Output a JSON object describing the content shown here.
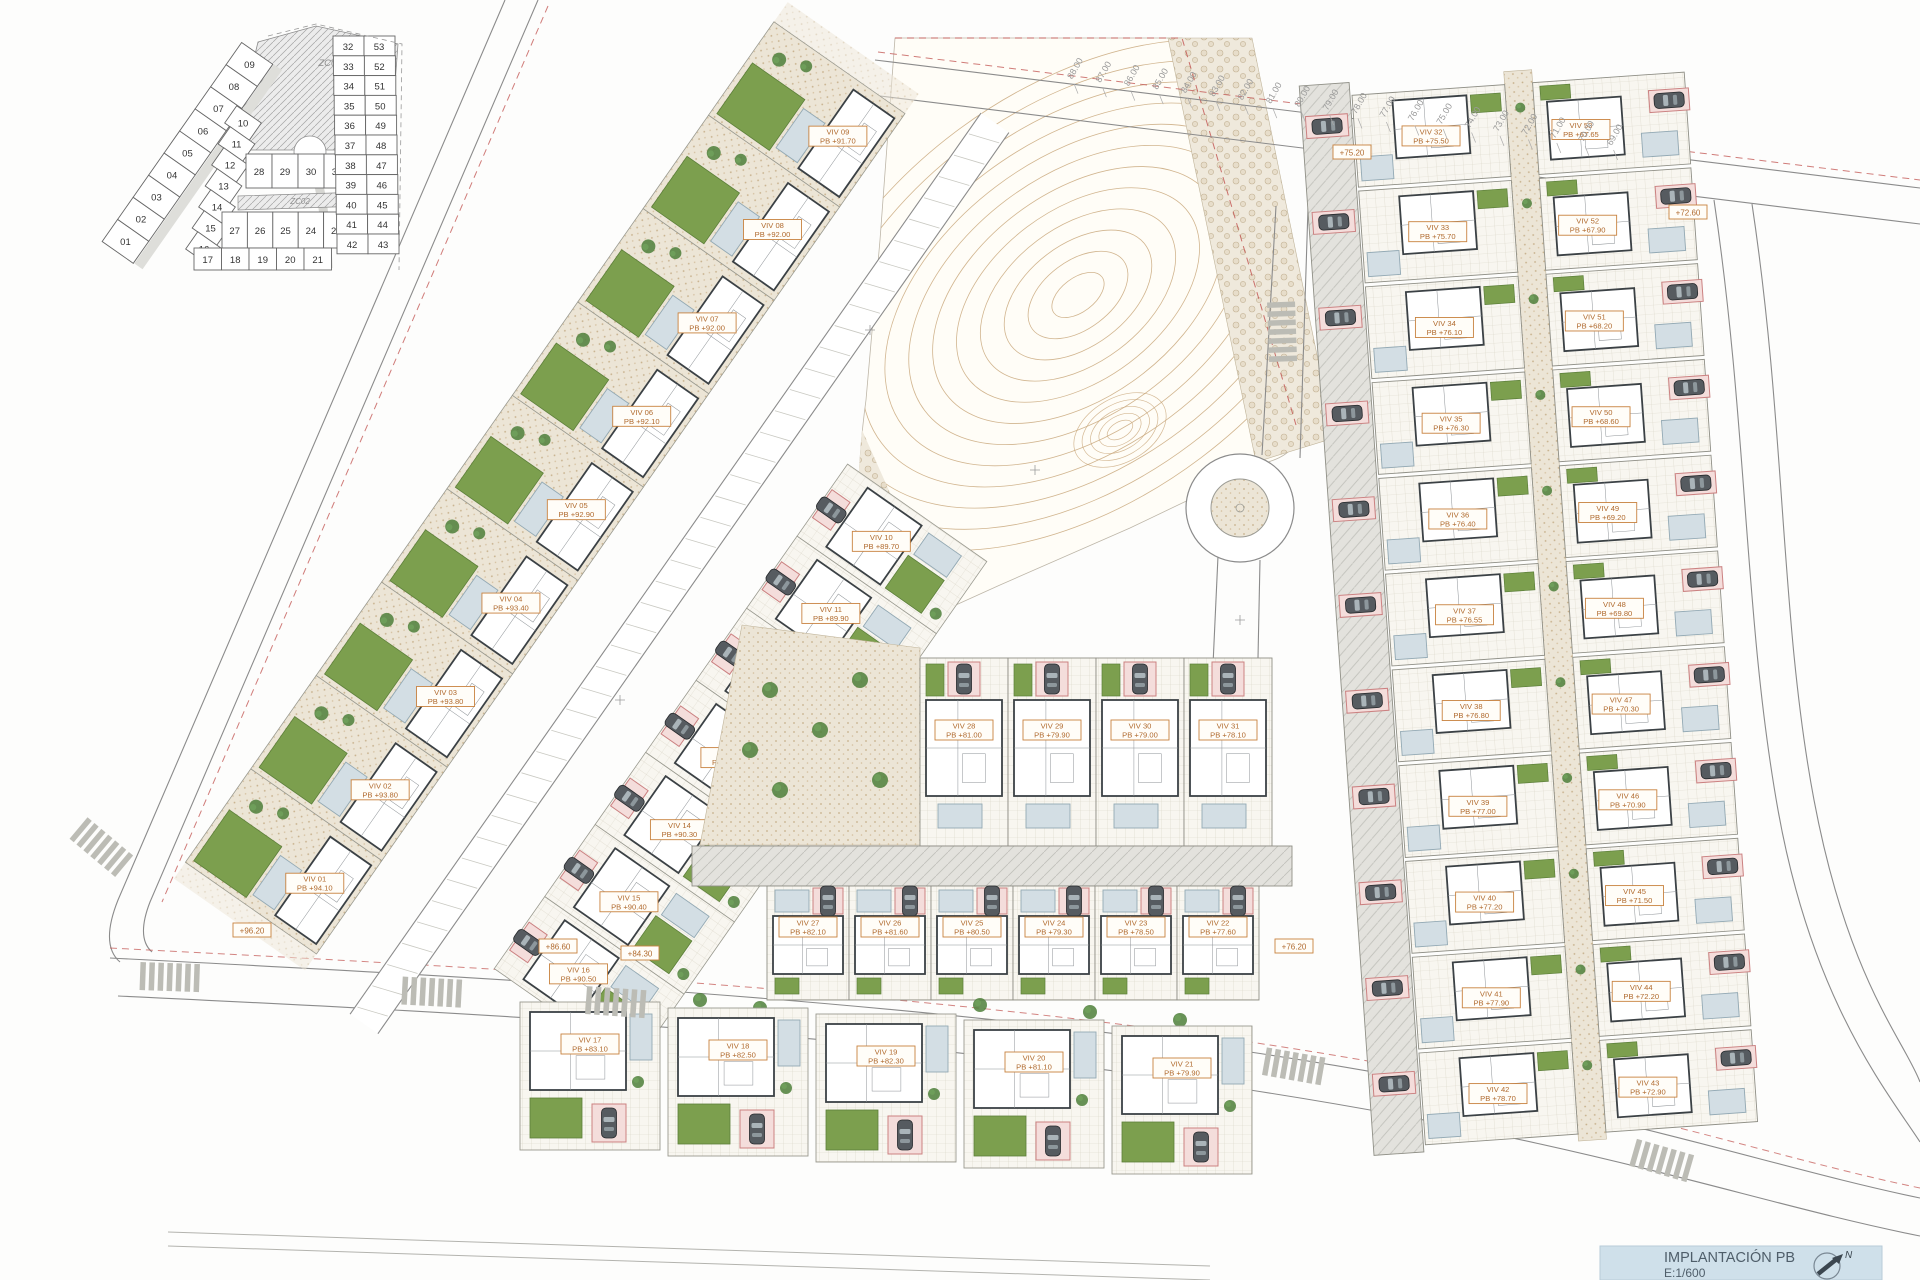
{
  "title_block": {
    "title": "IMPLANTACIÓN PB",
    "scale": "E:1/600",
    "north": "N"
  },
  "zones": {
    "zc01": "ZC01",
    "zc02": "ZC02"
  },
  "keyplan": {
    "outer_row": [
      "01",
      "02",
      "03",
      "04",
      "05",
      "06",
      "07",
      "08",
      "09"
    ],
    "inner_row": [
      "10",
      "11",
      "12",
      "13",
      "14",
      "15",
      "16"
    ],
    "mid_row": [
      "28",
      "29",
      "30",
      "31"
    ],
    "court_row": [
      "27",
      "26",
      "25",
      "24",
      "23",
      "22"
    ],
    "bottom_row": [
      "17",
      "18",
      "19",
      "20",
      "21"
    ],
    "right_left_col": [
      "32",
      "33",
      "34",
      "35",
      "36",
      "37",
      "38",
      "39",
      "40",
      "41",
      "42"
    ],
    "right_right_col": [
      "53",
      "52",
      "51",
      "50",
      "49",
      "48",
      "47",
      "46",
      "45",
      "44",
      "43"
    ]
  },
  "villas": {
    "left_outer": [
      {
        "id": "VIV 01",
        "pb": "PB +94.10"
      },
      {
        "id": "VIV 02",
        "pb": "PB +93.80"
      },
      {
        "id": "VIV 03",
        "pb": "PB +93.80"
      },
      {
        "id": "VIV 04",
        "pb": "PB +93.40"
      },
      {
        "id": "VIV 05",
        "pb": "PB +92.90"
      },
      {
        "id": "VIV 06",
        "pb": "PB +92.10"
      },
      {
        "id": "VIV 07",
        "pb": "PB +92.00"
      },
      {
        "id": "VIV 08",
        "pb": "PB +92.00"
      },
      {
        "id": "VIV 09",
        "pb": "PB +91.70"
      }
    ],
    "left_inner": [
      {
        "id": "VIV 10",
        "pb": "PB +89.70"
      },
      {
        "id": "VIV 11",
        "pb": "PB +89.90"
      },
      {
        "id": "VIV 12",
        "pb": "PB +90.10"
      },
      {
        "id": "VIV 13",
        "pb": "PB +90.10"
      },
      {
        "id": "VIV 14",
        "pb": "PB +90.30"
      },
      {
        "id": "VIV 15",
        "pb": "PB +90.40"
      },
      {
        "id": "VIV 16",
        "pb": "PB +90.50"
      }
    ],
    "bottom_row": [
      {
        "id": "VIV 17",
        "pb": "PB +83.10"
      },
      {
        "id": "VIV 18",
        "pb": "PB +82.50"
      },
      {
        "id": "VIV 19",
        "pb": "PB +82.30"
      },
      {
        "id": "VIV 20",
        "pb": "PB +81.10"
      },
      {
        "id": "VIV 21",
        "pb": "PB +79.90"
      }
    ],
    "cluster_top": [
      {
        "id": "VIV 28",
        "pb": "PB +81.00"
      },
      {
        "id": "VIV 29",
        "pb": "PB +79.90"
      },
      {
        "id": "VIV 30",
        "pb": "PB +79.00"
      },
      {
        "id": "VIV 31",
        "pb": "PB +78.10"
      }
    ],
    "cluster_bottom": [
      {
        "id": "VIV 27",
        "pb": "PB +82.10"
      },
      {
        "id": "VIV 26",
        "pb": "PB +81.60"
      },
      {
        "id": "VIV 25",
        "pb": "PB +80.50"
      },
      {
        "id": "VIV 24",
        "pb": "PB +79.30"
      },
      {
        "id": "VIV 23",
        "pb": "PB +78.50"
      },
      {
        "id": "VIV 22",
        "pb": "PB +77.60"
      }
    ],
    "right_west": [
      {
        "id": "VIV 32",
        "pb": "PB +75.50"
      },
      {
        "id": "VIV 33",
        "pb": "PB +75.70"
      },
      {
        "id": "VIV 34",
        "pb": "PB +76.10"
      },
      {
        "id": "VIV 35",
        "pb": "PB +76.30"
      },
      {
        "id": "VIV 36",
        "pb": "PB +76.40"
      },
      {
        "id": "VIV 37",
        "pb": "PB +76.55"
      },
      {
        "id": "VIV 38",
        "pb": "PB +76.80"
      },
      {
        "id": "VIV 39",
        "pb": "PB +77.00"
      },
      {
        "id": "VIV 40",
        "pb": "PB +77.20"
      },
      {
        "id": "VIV 41",
        "pb": "PB +77.90"
      },
      {
        "id": "VIV 42",
        "pb": "PB +78.70"
      }
    ],
    "right_east": [
      {
        "id": "VIV 53",
        "pb": "PB +67.65"
      },
      {
        "id": "VIV 52",
        "pb": "PB +67.90"
      },
      {
        "id": "VIV 51",
        "pb": "PB +68.20"
      },
      {
        "id": "VIV 50",
        "pb": "PB +68.60"
      },
      {
        "id": "VIV 49",
        "pb": "PB +69.20"
      },
      {
        "id": "VIV 48",
        "pb": "PB +69.80"
      },
      {
        "id": "VIV 47",
        "pb": "PB +70.30"
      },
      {
        "id": "VIV 46",
        "pb": "PB +70.90"
      },
      {
        "id": "VIV 45",
        "pb": "PB +71.50"
      },
      {
        "id": "VIV 44",
        "pb": "PB +72.20"
      },
      {
        "id": "VIV 43",
        "pb": "PB +72.90"
      }
    ]
  },
  "elevation_ticks": [
    "88.00",
    "87.00",
    "86.00",
    "85.00",
    "84.00",
    "83.00",
    "82.00",
    "81.00",
    "80.00",
    "79.00",
    "78.00",
    "77.00",
    "76.00",
    "75.00",
    "74.00",
    "73.00",
    "72.00",
    "71.00",
    "70.00",
    "69.00"
  ],
  "spot_levels": [
    {
      "t": "+96.20"
    },
    {
      "t": "+86.60"
    },
    {
      "t": "+84.30"
    },
    {
      "t": "+76.20"
    },
    {
      "t": "+75.20"
    },
    {
      "t": "+72.60"
    }
  ]
}
